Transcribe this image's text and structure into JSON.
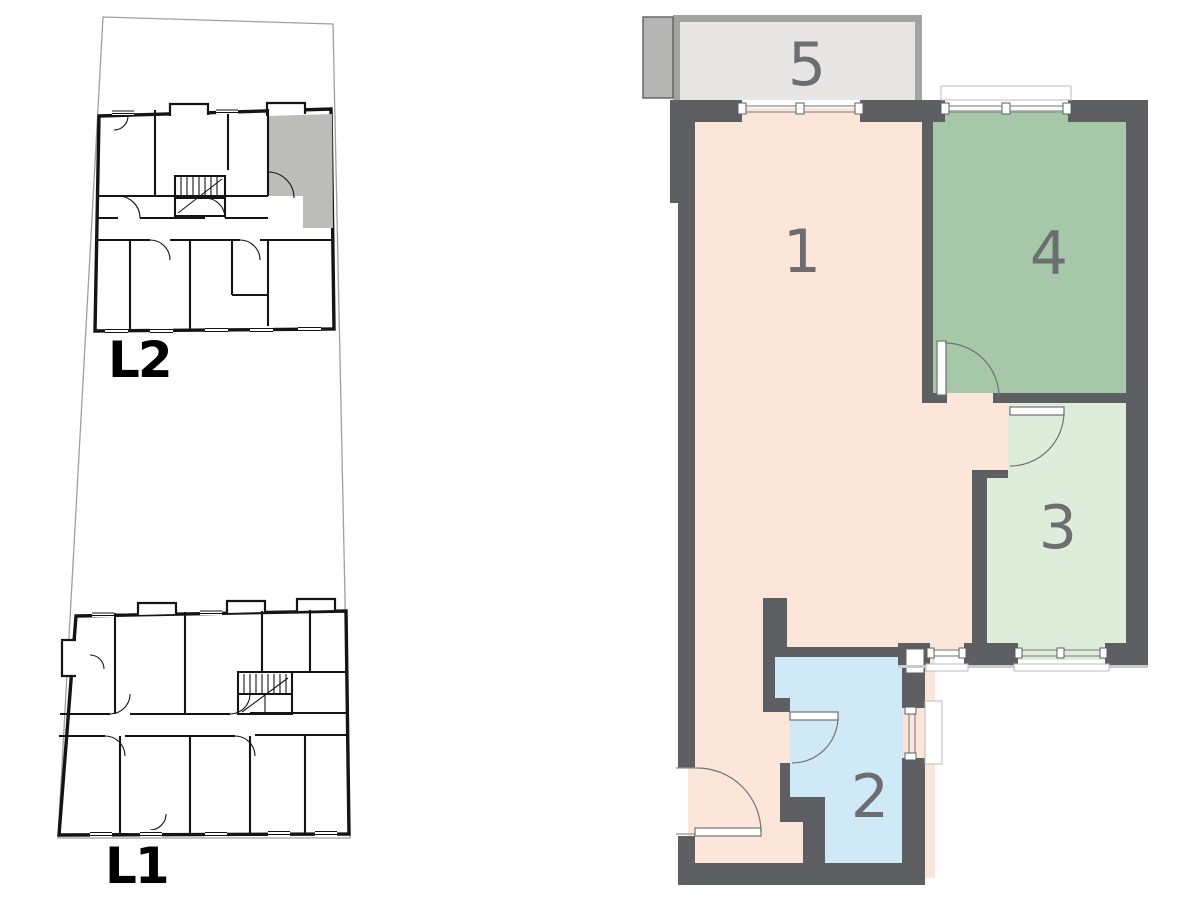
{
  "sheet": {
    "background": "#ffffff",
    "type_hint": "apartment floor plan with level key plans"
  },
  "site_plans": {
    "levels": [
      {
        "id": "L2",
        "label": "L2",
        "highlighted_unit": true
      },
      {
        "id": "L1",
        "label": "L1",
        "highlighted_unit": false
      }
    ],
    "highlight_color": "#bcbcbb",
    "line_color": "#141414",
    "parcel_line_color": "#a0a0a0"
  },
  "floor_plan": {
    "wall_color": "#5d5f63",
    "label_color": "#6d6e71",
    "balcony_border_color": "#a3a3a2",
    "side_panel_color": "#b5b5b4",
    "rooms": [
      {
        "number": "1",
        "color": "#fce6d9"
      },
      {
        "number": "2",
        "color": "#cfe9f6"
      },
      {
        "number": "3",
        "color": "#deedda"
      },
      {
        "number": "4",
        "color": "#a6c8a9"
      },
      {
        "number": "5",
        "color": "#e7e6e4"
      }
    ]
  }
}
